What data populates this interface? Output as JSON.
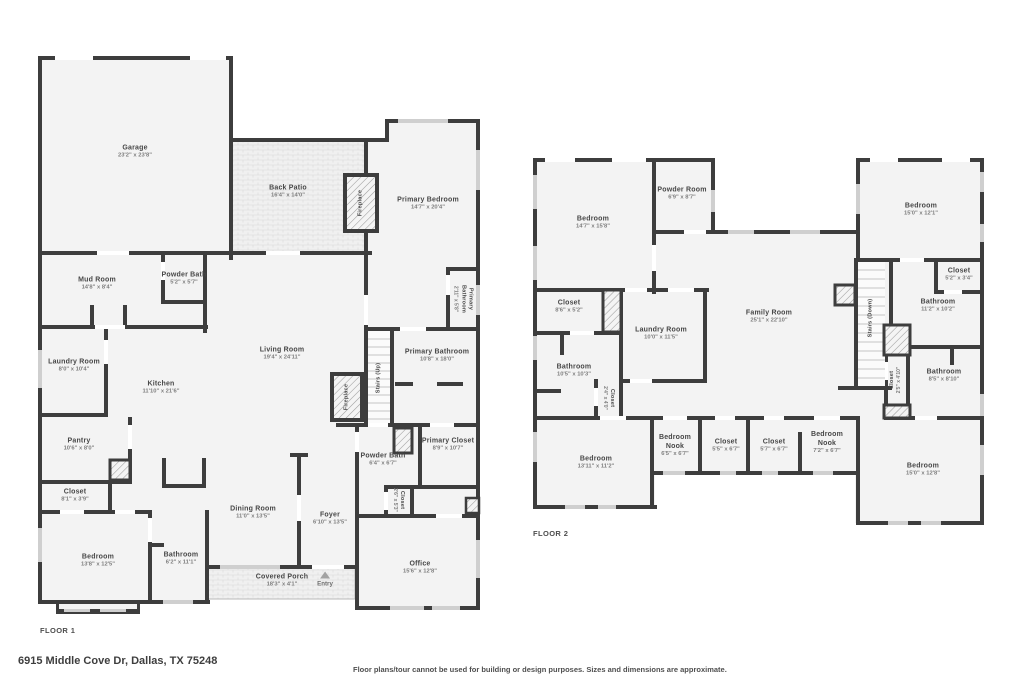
{
  "page": {
    "address": "6915 Middle Cove Dr, Dallas, TX 75248",
    "disclaimer": "Floor plans/tour cannot be used for building or design purposes. Sizes and dimensions are approximate."
  },
  "colors": {
    "wall": "#3d3d3d",
    "room_fill": "#f3f3f3",
    "window": "#cfcfcf",
    "texture_line": "#e0e0e0",
    "background": "#ffffff"
  },
  "floor1": {
    "label": "FLOOR 1",
    "rooms": [
      {
        "name": "Garage",
        "dims": "23'2\" x 23'8\""
      },
      {
        "name": "Back Patio",
        "dims": "16'4\" x 14'0\""
      },
      {
        "name": "Fireplace",
        "dims": ""
      },
      {
        "name": "Primary Bedroom",
        "dims": "14'7\" x 20'4\""
      },
      {
        "name": "Mud Room",
        "dims": "14'8\" x 8'4\""
      },
      {
        "name": "Powder Bath",
        "dims": "5'2\" x 5'7\""
      },
      {
        "name": "Primary Bathroom",
        "dims": "2'11\" x 5'8\""
      },
      {
        "name": "Laundry Room",
        "dims": "8'0\" x 10'4\""
      },
      {
        "name": "Kitchen",
        "dims": "11'10\" x 21'6\""
      },
      {
        "name": "Living Room",
        "dims": "19'4\" x 24'11\""
      },
      {
        "name": "Stairs (Up)",
        "dims": ""
      },
      {
        "name": "Fireplace",
        "dims": ""
      },
      {
        "name": "Primary Bathroom",
        "dims": "10'8\" x 18'0\""
      },
      {
        "name": "Pantry",
        "dims": "10'6\" x 8'0\""
      },
      {
        "name": "Powder Bath",
        "dims": "6'4\" x 6'7\""
      },
      {
        "name": "Primary Closet",
        "dims": "8'9\" x 10'7\""
      },
      {
        "name": "Closet",
        "dims": "8'1\" x 3'9\""
      },
      {
        "name": "Closet",
        "dims": "2'6\" x 5'3\""
      },
      {
        "name": "Dining Room",
        "dims": "11'0\" x 13'5\""
      },
      {
        "name": "Foyer",
        "dims": "6'10\" x 13'5\""
      },
      {
        "name": "Bedroom",
        "dims": "13'8\" x 12'5\""
      },
      {
        "name": "Bathroom",
        "dims": "6'2\" x 11'1\""
      },
      {
        "name": "Covered Porch",
        "dims": "18'3\" x 4'1\""
      },
      {
        "name": "Entry",
        "dims": ""
      },
      {
        "name": "Office",
        "dims": "15'6\" x 12'8\""
      }
    ]
  },
  "floor2": {
    "label": "FLOOR 2",
    "rooms": [
      {
        "name": "Bedroom",
        "dims": "14'7\" x 15'8\""
      },
      {
        "name": "Powder Room",
        "dims": "6'9\" x 8'7\""
      },
      {
        "name": "Bedroom",
        "dims": "15'0\" x 12'1\""
      },
      {
        "name": "Closet",
        "dims": "8'6\" x 5'2\""
      },
      {
        "name": "Laundry Room",
        "dims": "10'0\" x 11'5\""
      },
      {
        "name": "Family Room",
        "dims": "25'1\" x 22'10\""
      },
      {
        "name": "Stairs (Down)",
        "dims": ""
      },
      {
        "name": "Closet",
        "dims": "5'2\" x 3'4\""
      },
      {
        "name": "Bathroom",
        "dims": "11'2\" x 10'2\""
      },
      {
        "name": "Bathroom",
        "dims": "10'5\" x 10'3\""
      },
      {
        "name": "Closet",
        "dims": "2'4\" x 4'0\""
      },
      {
        "name": "Closet",
        "dims": "2'5\" x 4'10\""
      },
      {
        "name": "Bathroom",
        "dims": "8'5\" x 8'10\""
      },
      {
        "name": "Bedroom",
        "dims": "13'11\" x 11'2\""
      },
      {
        "name": "Bedroom Nook",
        "dims": "6'5\" x 6'7\""
      },
      {
        "name": "Closet",
        "dims": "5'5\" x 6'7\""
      },
      {
        "name": "Closet",
        "dims": "5'7\" x 6'7\""
      },
      {
        "name": "Bedroom Nook",
        "dims": "7'2\" x 6'7\""
      },
      {
        "name": "Bedroom",
        "dims": "15'0\" x 12'8\""
      }
    ]
  }
}
